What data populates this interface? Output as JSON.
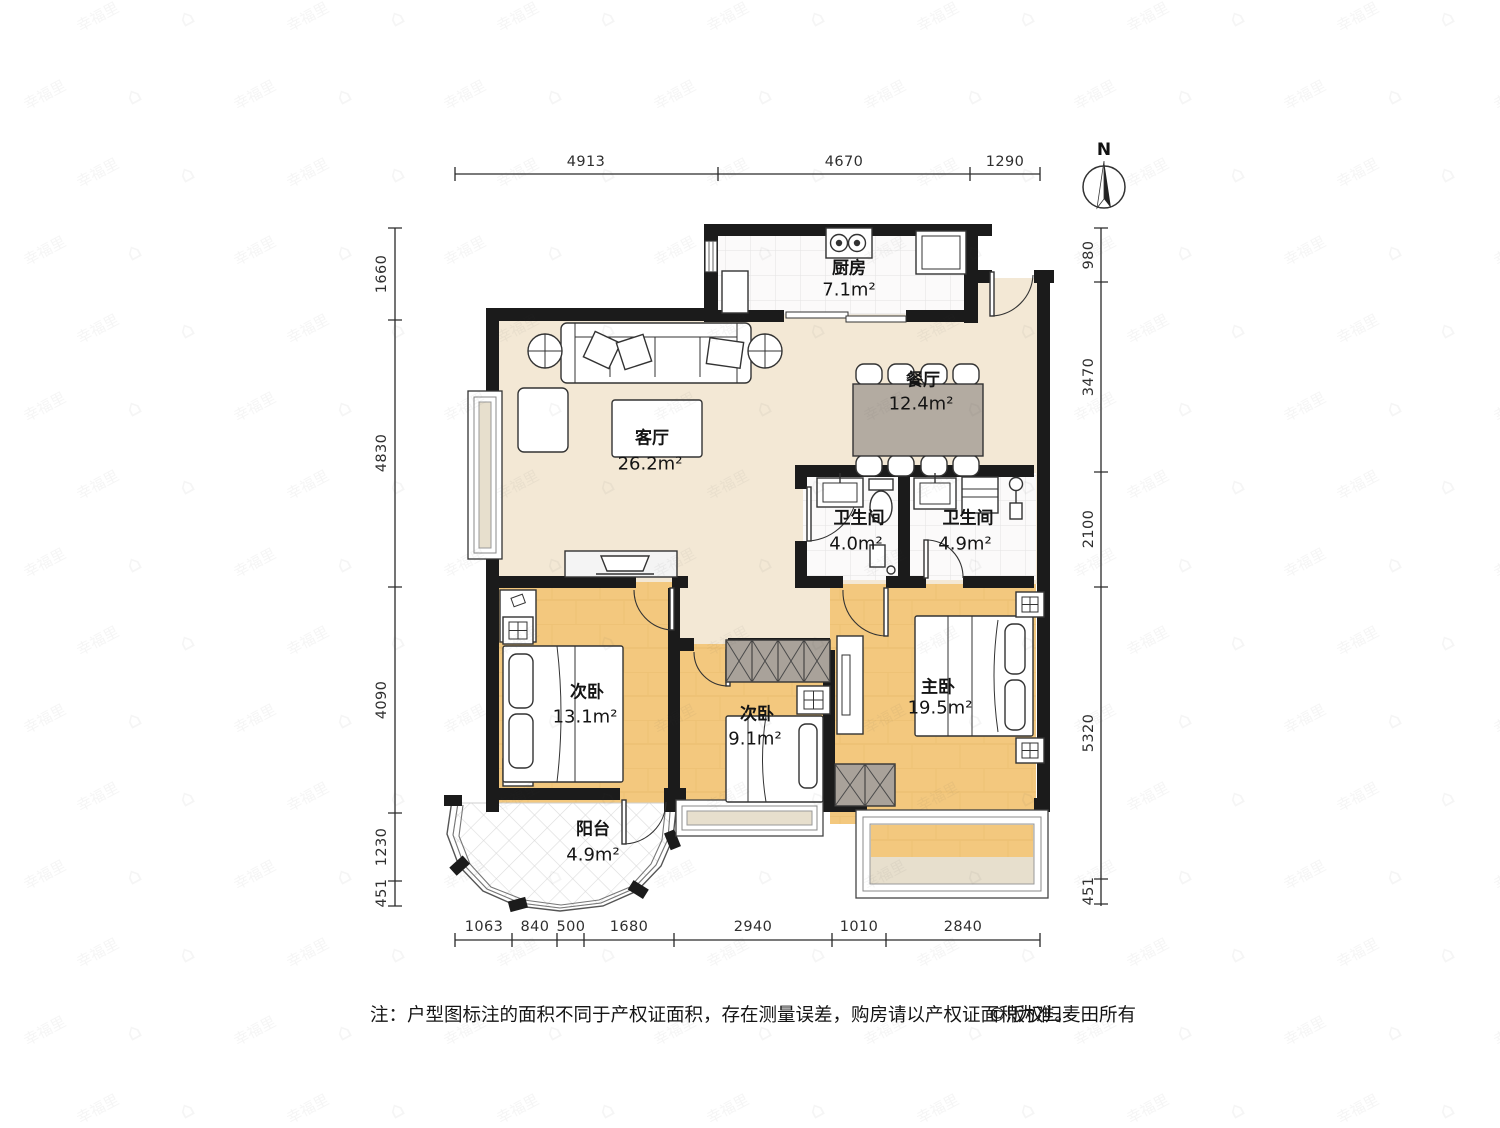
{
  "compass": {
    "label": "N"
  },
  "watermark": {
    "text": "幸福里",
    "icon": "house-icon"
  },
  "dims": {
    "top": [
      "4913",
      "4670",
      "1290"
    ],
    "bottom": [
      "1063",
      "840",
      "500",
      "1680",
      "2940",
      "1010",
      "2840"
    ],
    "left": [
      "1660",
      "4830",
      "4090",
      "1230",
      "451"
    ],
    "right": [
      "980",
      "3470",
      "2100",
      "5320",
      "451"
    ]
  },
  "rooms": {
    "kitchen": {
      "name": "厨房",
      "area": "7.1m²"
    },
    "dining": {
      "name": "餐厅",
      "area": "12.4m²"
    },
    "living": {
      "name": "客厅",
      "area": "26.2m²"
    },
    "bath_a": {
      "name": "卫生间",
      "area": "4.0m²"
    },
    "bath_b": {
      "name": "卫生间",
      "area": "4.9m²"
    },
    "bedroom_b1": {
      "name": "次卧",
      "area": "13.1m²"
    },
    "bedroom_b2": {
      "name": "次卧",
      "area": "9.1m²"
    },
    "master": {
      "name": "主卧",
      "area": "19.5m²"
    },
    "balcony": {
      "name": "阳台",
      "area": "4.9m²"
    }
  },
  "footer": {
    "note": "注：户型图标注的面积不同于产权证面积，存在测量误差，购房请以产权证面积为准。",
    "copyright": "©版权归麦田所有"
  },
  "colors": {
    "wall": "#1b1b1b",
    "floor_main": "#f3e8d5",
    "floor_wood": "#f3c87e",
    "furniture_gray": "#a9a29a",
    "dining_table": "#b3aba1",
    "window_sill": "#e7dfcd"
  }
}
